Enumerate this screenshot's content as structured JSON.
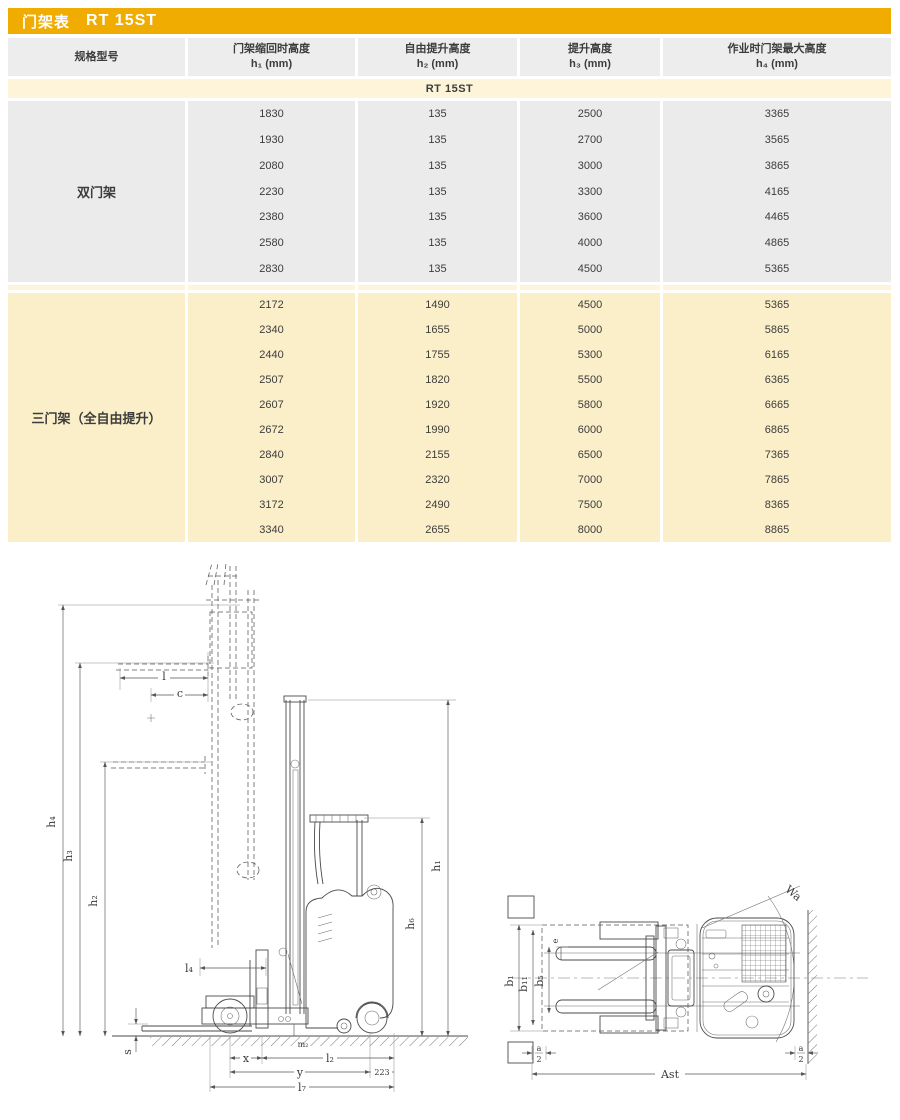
{
  "header": {
    "title_label": "门架表",
    "title_model": "RT 15ST"
  },
  "table": {
    "columns": [
      {
        "title": "规格型号",
        "sub": ""
      },
      {
        "title": "门架缩回时高度",
        "sub": "h₁ (mm)"
      },
      {
        "title": "自由提升高度",
        "sub": "h₂ (mm)"
      },
      {
        "title": "提升高度",
        "sub": "h₃ (mm)"
      },
      {
        "title": "作业时门架最大高度",
        "sub": "h₄ (mm)"
      }
    ],
    "model_row": "RT 15ST",
    "sections": [
      {
        "name": "双门架",
        "style": "gray",
        "rows": [
          [
            "1830",
            "135",
            "2500",
            "3365"
          ],
          [
            "1930",
            "135",
            "2700",
            "3565"
          ],
          [
            "2080",
            "135",
            "3000",
            "3865"
          ],
          [
            "2230",
            "135",
            "3300",
            "4165"
          ],
          [
            "2380",
            "135",
            "3600",
            "4465"
          ],
          [
            "2580",
            "135",
            "4000",
            "4865"
          ],
          [
            "2830",
            "135",
            "4500",
            "5365"
          ]
        ]
      },
      {
        "name": "三门架（全自由提升）",
        "style": "cream",
        "rows": [
          [
            "2172",
            "1490",
            "4500",
            "5365"
          ],
          [
            "2340",
            "1655",
            "5000",
            "5865"
          ],
          [
            "2440",
            "1755",
            "5300",
            "6165"
          ],
          [
            "2507",
            "1820",
            "5500",
            "6365"
          ],
          [
            "2607",
            "1920",
            "5800",
            "6665"
          ],
          [
            "2672",
            "1990",
            "6000",
            "6865"
          ],
          [
            "2840",
            "2155",
            "6500",
            "7365"
          ],
          [
            "3007",
            "2320",
            "7000",
            "7865"
          ],
          [
            "3172",
            "2490",
            "7500",
            "8365"
          ],
          [
            "3340",
            "2655",
            "8000",
            "8865"
          ]
        ]
      }
    ]
  },
  "colors": {
    "accent_gold": "#F0AC00",
    "cream_light": "#FDF4DA",
    "cream_deep": "#FBEFC9",
    "cell_gray": "#EBEBEB",
    "text": "#3C3C3C"
  },
  "drawings": {
    "side_view": {
      "labels": {
        "h4": "h₄",
        "h3": "h₃",
        "h2": "h₂",
        "h6": "h₆",
        "h1": "h₁",
        "l": "l",
        "c": "c",
        "l4": "l₄",
        "s": "s",
        "m2": "m₂",
        "x": "x",
        "l2": "l₂",
        "y": "y",
        "rear_overhang": "223",
        "l7": "l₇"
      }
    },
    "top_view": {
      "labels": {
        "b1": "b₁",
        "b11": "b₁₁",
        "b5": "b₅",
        "e": "e",
        "wa": "Wa",
        "ast": "Ast",
        "a_num": "a",
        "a_den": "2"
      }
    }
  }
}
